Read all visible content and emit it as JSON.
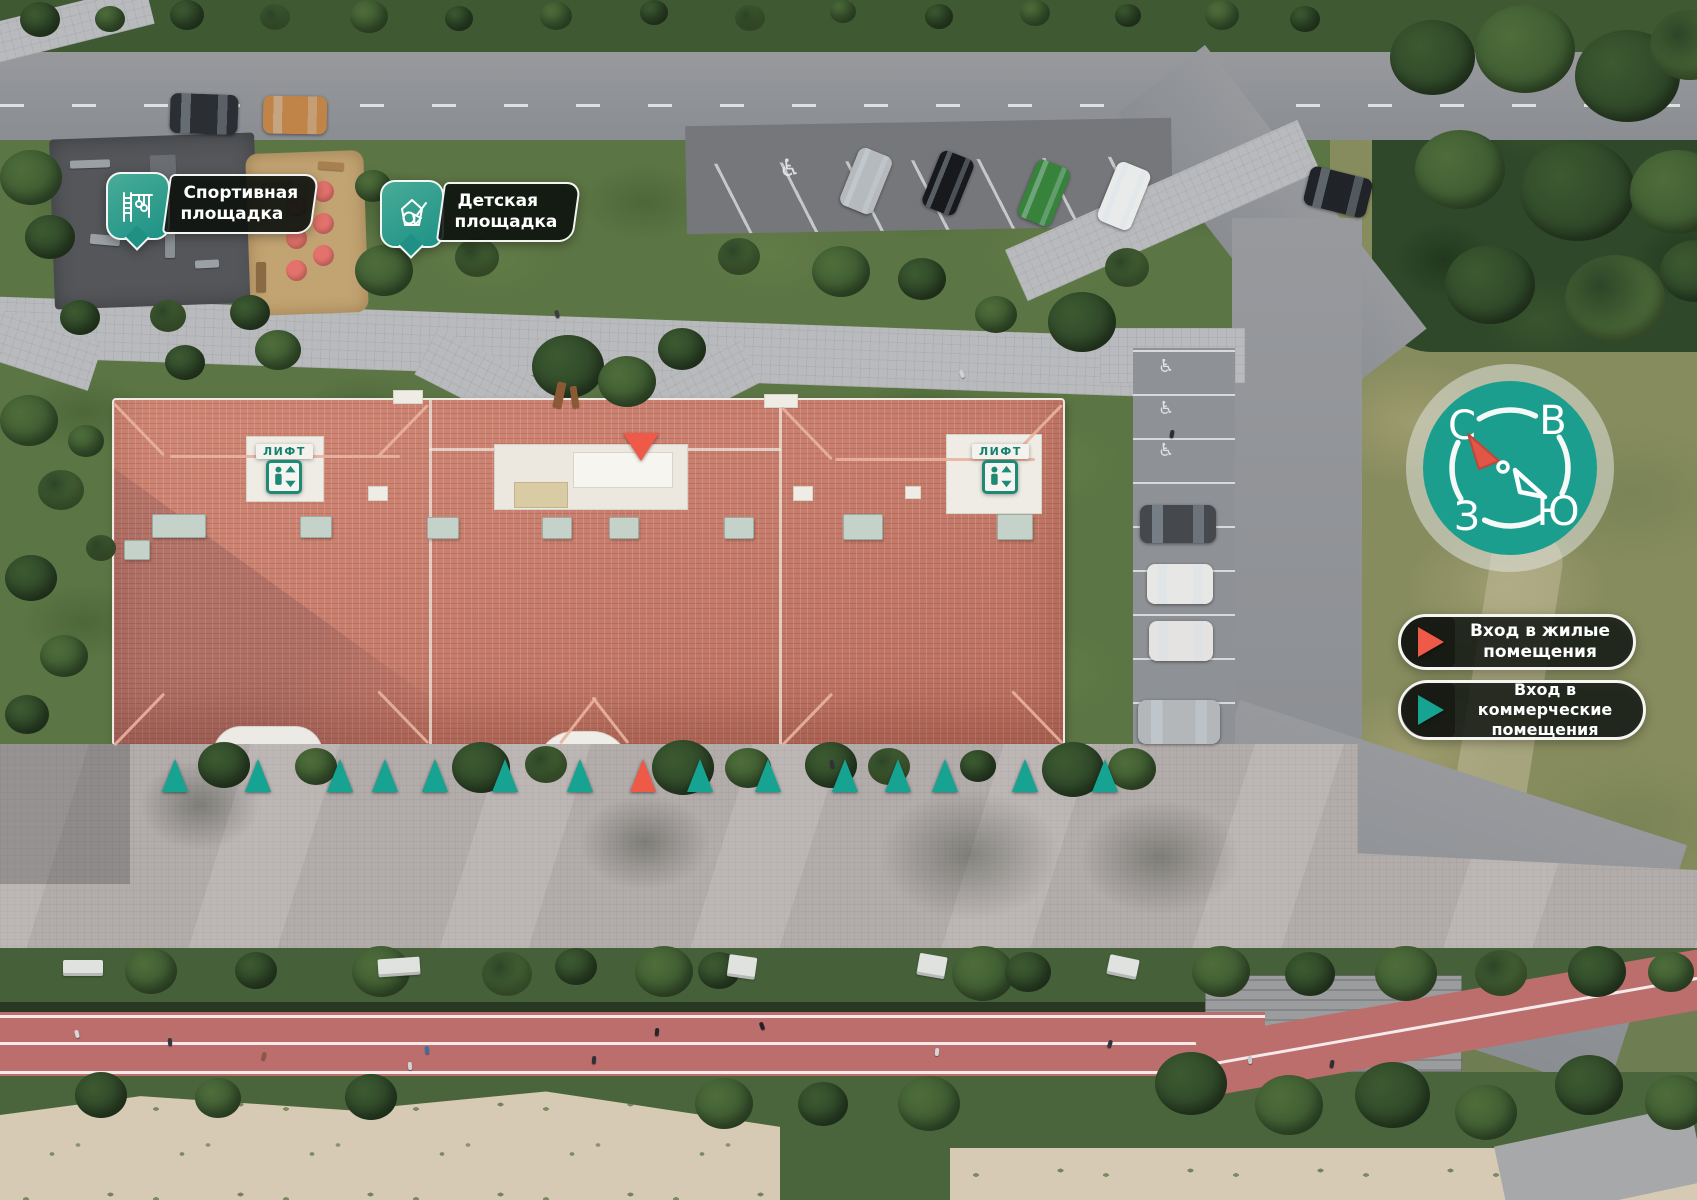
{
  "overlay": {
    "badges": [
      {
        "id": "sports-ground",
        "icon": "sports-equipment-icon",
        "line1": "Спортивная",
        "line2": "площадка"
      },
      {
        "id": "kids-playground",
        "icon": "sand-bucket-icon",
        "line1": "Детская",
        "line2": "площадка"
      }
    ],
    "lift_sign_label": "ЛИФТ",
    "legend": [
      {
        "id": "residential-entrance",
        "line1": "Вход в жилые",
        "line2": "помещения",
        "marker_color": "#EE5A47"
      },
      {
        "id": "commercial-entrance",
        "line1": "Вход в коммерческие",
        "line2": "помещения",
        "marker_color": "#16A392"
      }
    ],
    "compass": {
      "north": "С",
      "east": "В",
      "west": "З",
      "south": "Ю"
    },
    "colors": {
      "accent_teal": "#16A392",
      "accent_red": "#EE5A47",
      "roof_terracotta": "#C87F6E",
      "badge_teal": "#2E9E8C"
    }
  },
  "entrance_markers": {
    "residential_color": "#EE5A47",
    "commercial_color": "#16A392",
    "north_row": [
      {
        "x": 641,
        "y": 433,
        "type": "residential",
        "direction": "down"
      }
    ],
    "south_row": [
      {
        "x": 175,
        "type": "commercial"
      },
      {
        "x": 258,
        "type": "commercial"
      },
      {
        "x": 340,
        "type": "commercial"
      },
      {
        "x": 385,
        "type": "commercial"
      },
      {
        "x": 435,
        "type": "commercial"
      },
      {
        "x": 505,
        "type": "commercial"
      },
      {
        "x": 580,
        "type": "commercial"
      },
      {
        "x": 643,
        "type": "residential"
      },
      {
        "x": 700,
        "type": "commercial"
      },
      {
        "x": 768,
        "type": "commercial"
      },
      {
        "x": 845,
        "type": "commercial"
      },
      {
        "x": 898,
        "type": "commercial"
      },
      {
        "x": 945,
        "type": "commercial"
      },
      {
        "x": 1025,
        "type": "commercial"
      },
      {
        "x": 1105,
        "type": "commercial"
      }
    ]
  }
}
